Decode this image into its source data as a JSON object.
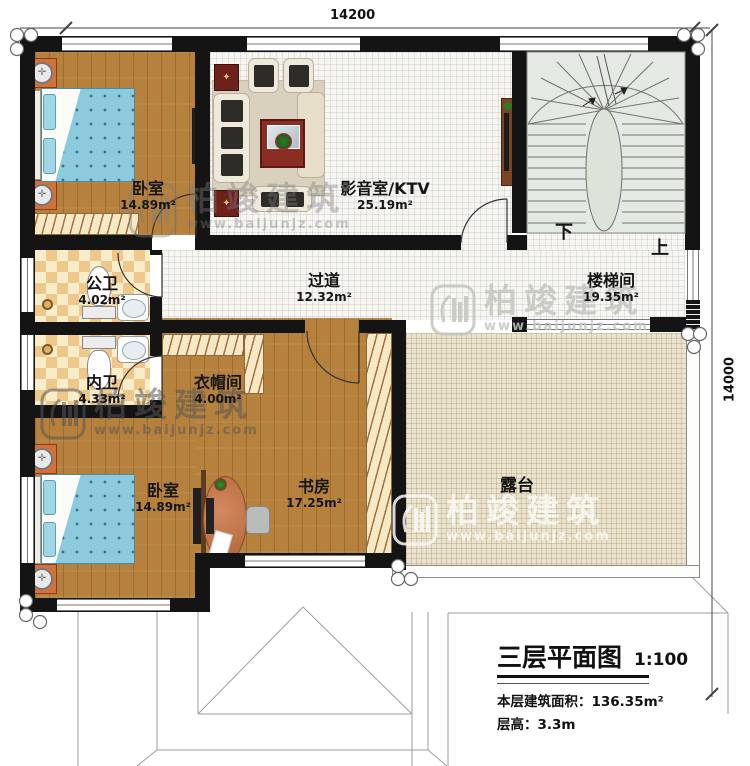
{
  "dimensions": {
    "width_mm": "14200",
    "height_mm": "14000"
  },
  "rooms": [
    {
      "name": "卧室",
      "area": "14.89m²"
    },
    {
      "name": "影音室/KTV",
      "area": "25.19m²"
    },
    {
      "name": "楼梯间",
      "area": "19.35m²"
    },
    {
      "name": "公卫",
      "area": "4.02m²"
    },
    {
      "name": "过道",
      "area": "12.32m²"
    },
    {
      "name": "内卫",
      "area": "4.33m²"
    },
    {
      "name": "衣帽间",
      "area": "4.00m²"
    },
    {
      "name": "卧室",
      "area": "14.89m²"
    },
    {
      "name": "书房",
      "area": "17.25m²"
    },
    {
      "name": "露台",
      "area": ""
    }
  ],
  "stairs": {
    "down": "下",
    "up": "上"
  },
  "title_block": {
    "title": "三层平面图",
    "scale": "1:100",
    "building_area": "本层建筑面积：136.35m²",
    "floor_height": "层高：3.3m"
  },
  "watermark": {
    "brand": "柏竣建筑",
    "url": "www.baijunjz.com"
  },
  "colors": {
    "wall": "#141414",
    "wood_floor": "#b5813d",
    "tile_floor": "#f7f6f3",
    "terrace_floor": "#ebe3cd",
    "stair_fill": "#e4e9e3",
    "accent_furniture": "#d2713c",
    "bed_blue": "#8ccadd",
    "dark_red": "#6e211b"
  }
}
